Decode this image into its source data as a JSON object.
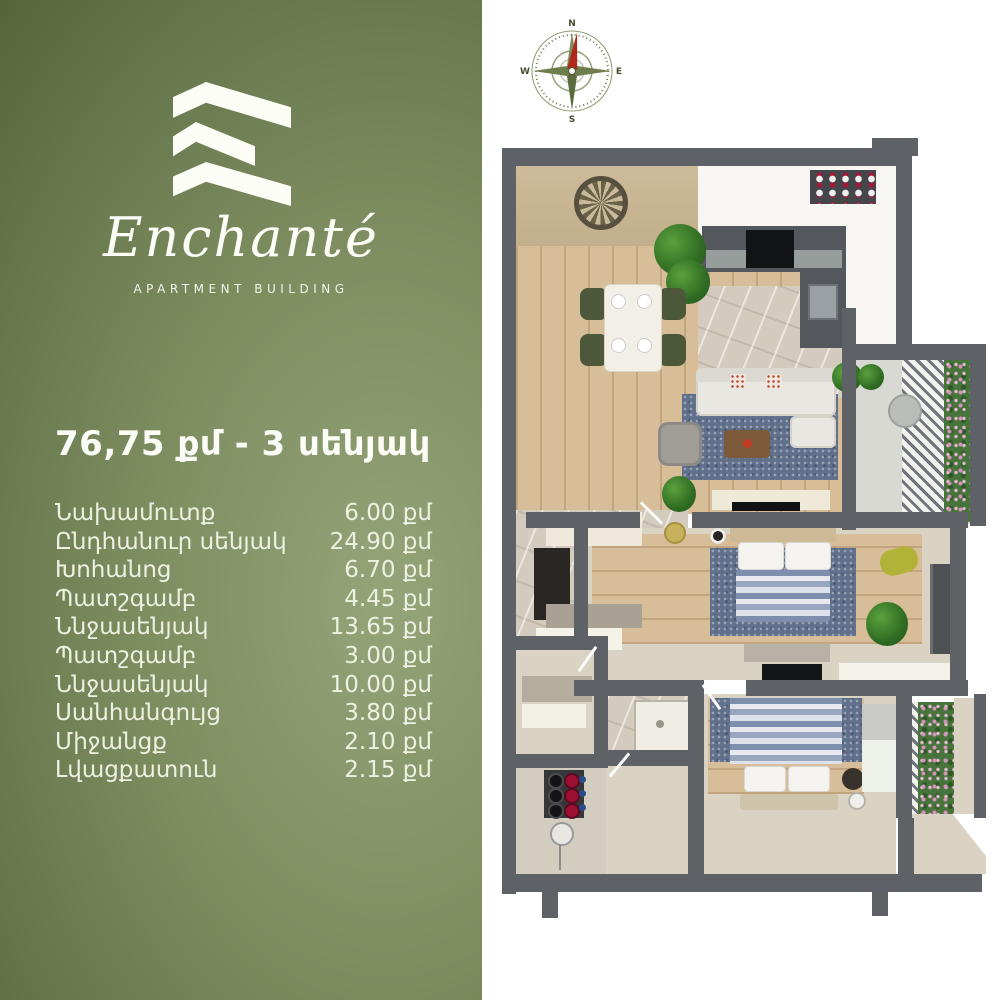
{
  "brand": {
    "name": "Enchanté",
    "tagline": "APARTMENT BUILDING"
  },
  "listing": {
    "title": "76,75 քմ - 3 սենյակ",
    "rooms": [
      {
        "name": "Նախամուտք",
        "area": "6.00 քմ"
      },
      {
        "name": "Ընդհանուր սենյակ",
        "area": "24.90 քմ"
      },
      {
        "name": "Խոհանոց",
        "area": "6.70 քմ"
      },
      {
        "name": "Պատշգամբ",
        "area": "4.45 քմ"
      },
      {
        "name": "Ննջասենյակ",
        "area": "13.65 քմ"
      },
      {
        "name": "Պատշգամբ",
        "area": "3.00 քմ"
      },
      {
        "name": "Ննջասենյակ",
        "area": "10.00 քմ"
      },
      {
        "name": "Սանհանգույց",
        "area": "3.80 քմ"
      },
      {
        "name": "Միջանցք",
        "area": "2.10 քմ"
      },
      {
        "name": "Լվացքատուն",
        "area": "2.15 քմ"
      }
    ]
  },
  "compass": {
    "north": "N",
    "south": "S",
    "east": "E",
    "west": "W"
  },
  "colors": {
    "panel_green_light": "#95a479",
    "panel_green_dark": "#4c5b32",
    "text": "#eef1e1",
    "wall": "#5e6165",
    "wood": "#d7bd98",
    "rug_blue": "#61708a",
    "needle_red": "#b02a1c"
  }
}
